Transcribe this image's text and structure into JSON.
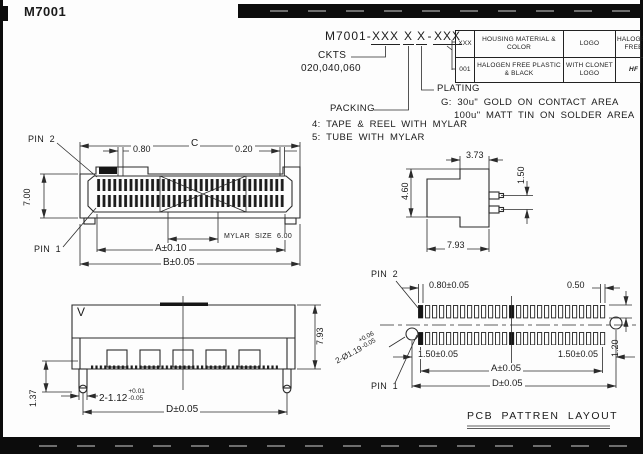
{
  "sheet": {
    "title": "M7001",
    "ink": "#2b2b2b",
    "paper": "#fdfdfd"
  },
  "part_number": {
    "prefix": "M7001-",
    "ckts_code": "XXX",
    "packing_code": "X",
    "plating_code": "X",
    "separator": "-",
    "option_code": "XXX",
    "ckts_label": "CKTS",
    "ckts_values": "020,040,060",
    "packing_label": "PACKING",
    "packing_option_4": "4: TAPE & REEL WITH MYLAR",
    "packing_option_5": "5: TUBE WITH MYLAR",
    "plating_label": "PLATING",
    "plating_option_g": "G: 30u\" GOLD ON CONTACT AREA",
    "plating_option_g2": "100u\" MATT TIN ON SOLDER AREA"
  },
  "options_table": {
    "col_xxx": "XXX",
    "col_housing": "HOUSING MATERIAL & COLOR",
    "col_logo": "LOGO",
    "col_halogen": "HALOGEN FREE",
    "row_code": "001",
    "row_housing": "HALOGEN FREE PLASTIC & BLACK",
    "row_logo": "WITH CLONET LOGO",
    "row_halogen": "HF"
  },
  "top_view": {
    "pin2": "PIN 2",
    "pin1": "PIN 1",
    "dim_c": "C",
    "dim_pitch": "0.80",
    "dim_020": "0.20",
    "dim_height": "7.00",
    "mylar_note": "MYLAR SIZE 6.00",
    "dim_a": "A±0.10",
    "dim_b": "B±0.05"
  },
  "side_view": {
    "dim_width": "3.73",
    "dim_pin_pitch": "1.50",
    "dim_height": "4.60",
    "dim_depth": "7.93"
  },
  "front_view": {
    "v_mark": "V",
    "dim_height": "7.93",
    "dim_peg": "1.37",
    "dim_feet": "2-1.12",
    "tol_plus": "+0.01",
    "tol_minus": "-0.05",
    "dim_d": "D±0.05"
  },
  "pcb_layout": {
    "pin2": "PIN 2",
    "pin1": "PIN 1",
    "dim_pad": "0.80±0.05",
    "dim_gap": "0.50",
    "dim_row": "1.20",
    "dim_left": "1.50±0.05",
    "dim_right": "1.50±0.05",
    "dim_a": "A±0.05",
    "dim_d": "D±0.05",
    "hole_note": "2-Ø1.19",
    "hole_tol_plus": "+0.06",
    "hole_tol_minus": "-0.05",
    "title": "PCB PATTREN LAYOUT"
  }
}
